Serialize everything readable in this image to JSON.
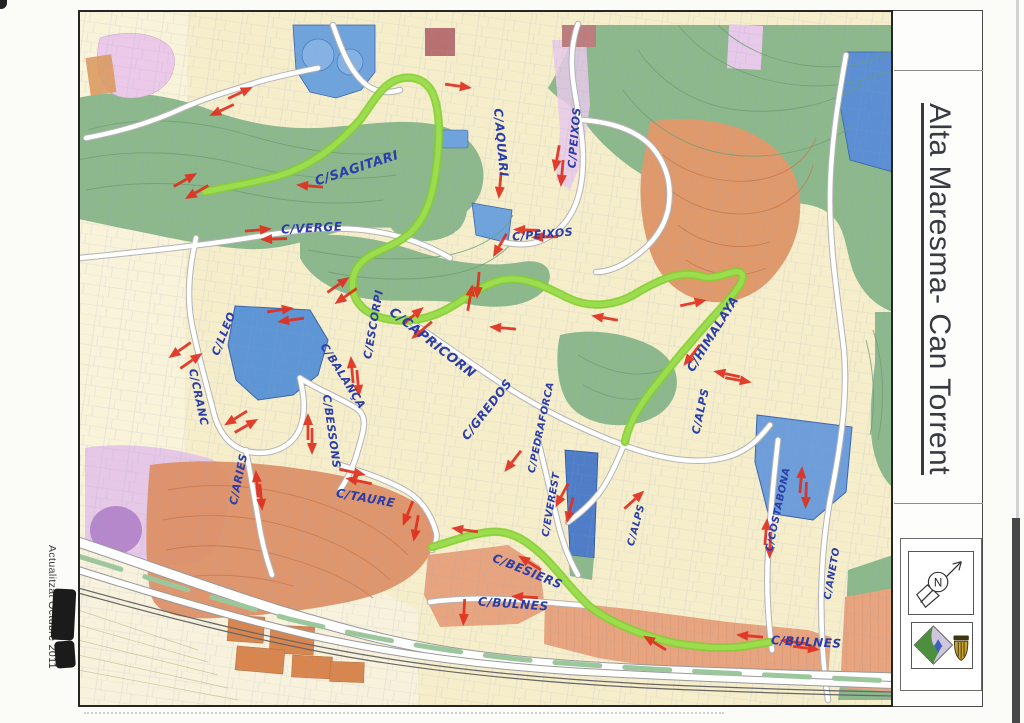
{
  "sheet": {
    "title": "Alta Maresma- Can Torrent",
    "margin_note": "Actualitzat",
    "margin_note_redacted": "Octubre 2011"
  },
  "legend": {
    "compass_letter": "N"
  },
  "map": {
    "colors": {
      "route": "#7fd41e",
      "arrow": "#e0301f",
      "handwriting": "#2b3da8"
    },
    "street_labels": [
      {
        "t": "C/SAGITARI",
        "x": 280,
        "y": 162,
        "r": -18,
        "s": 13
      },
      {
        "t": "C/VERGE",
        "x": 234,
        "y": 222,
        "r": -3,
        "s": 12
      },
      {
        "t": "C/AQUARI",
        "x": 419,
        "y": 133,
        "r": 85,
        "s": 12
      },
      {
        "t": "C/PEIXOS",
        "x": 465,
        "y": 228,
        "r": -5,
        "s": 11
      },
      {
        "t": "C/PEIXOS",
        "x": 500,
        "y": 128,
        "r": -85,
        "s": 11
      },
      {
        "t": "C/ESCORPI",
        "x": 299,
        "y": 315,
        "r": -80,
        "s": 11
      },
      {
        "t": "C/CAPRICORN",
        "x": 352,
        "y": 336,
        "r": 38,
        "s": 13
      },
      {
        "t": "C/LLEO",
        "x": 149,
        "y": 325,
        "r": -68,
        "s": 11
      },
      {
        "t": "C/CRANC",
        "x": 117,
        "y": 388,
        "r": 78,
        "s": 11
      },
      {
        "t": "C/BALANÇA",
        "x": 262,
        "y": 368,
        "r": 58,
        "s": 11
      },
      {
        "t": "C/BESSONS",
        "x": 250,
        "y": 422,
        "r": 82,
        "s": 11
      },
      {
        "t": "C/ARIES",
        "x": 164,
        "y": 470,
        "r": -78,
        "s": 11
      },
      {
        "t": "C/TAURE",
        "x": 287,
        "y": 492,
        "r": 10,
        "s": 12
      },
      {
        "t": "C/GREDOS",
        "x": 412,
        "y": 402,
        "r": -52,
        "s": 12
      },
      {
        "t": "C/PEDRAFORCA",
        "x": 466,
        "y": 418,
        "r": -78,
        "s": 10
      },
      {
        "t": "C/EVEREST",
        "x": 476,
        "y": 495,
        "r": -80,
        "s": 10
      },
      {
        "t": "C/ALPS",
        "x": 626,
        "y": 402,
        "r": -78,
        "s": 11
      },
      {
        "t": "C/HIMALAYA",
        "x": 638,
        "y": 326,
        "r": -58,
        "s": 12
      },
      {
        "t": "C/ALPS",
        "x": 561,
        "y": 516,
        "r": -75,
        "s": 10
      },
      {
        "t": "C/COSTABONA",
        "x": 703,
        "y": 500,
        "r": -78,
        "s": 10
      },
      {
        "t": "C/ANETO",
        "x": 757,
        "y": 564,
        "r": -80,
        "s": 10
      },
      {
        "t": "C/BESIERS",
        "x": 448,
        "y": 565,
        "r": 22,
        "s": 12
      },
      {
        "t": "C/BULNES",
        "x": 435,
        "y": 598,
        "r": 4,
        "s": 12
      },
      {
        "t": "C/BULNES",
        "x": 728,
        "y": 636,
        "r": 3,
        "s": 12
      }
    ],
    "routes": [
      "M127,182 C155,175 185,172 212,162 C242,150 262,132 282,110 C294,94 303,76 318,70 C334,64 348,70 354,82 C362,98 362,125 359,152 C356,180 350,205 334,221 C317,238 294,240 282,254 C271,267 272,287 286,299 C302,312 332,314 356,305 C381,296 396,278 420,271 C443,264 466,276 490,288 C513,299 540,296 562,281 C582,270 602,260 622,266 C640,272 658,256 664,264 C668,272 652,288 636,306 C616,328 596,352 577,376 C560,397 550,415 547,432",
      "M354,537 C372,532 392,524 412,522 C432,520 448,530 464,545 C478,558 492,578 510,595 C528,610 552,620 577,628 C602,636 640,640 668,636 C678,634 686,633 692,632"
    ],
    "arrows": [
      [
        162,
        83,
        -25
      ],
      [
        144,
        100,
        155
      ],
      [
        107,
        170,
        -30
      ],
      [
        119,
        182,
        150
      ],
      [
        232,
        176,
        185
      ],
      [
        380,
        76,
        8
      ],
      [
        422,
        175,
        95
      ],
      [
        422,
        235,
        120
      ],
      [
        479,
        148,
        100
      ],
      [
        484,
        163,
        95
      ],
      [
        449,
        220,
        182
      ],
      [
        467,
        227,
        178
      ],
      [
        180,
        220,
        -5
      ],
      [
        196,
        229,
        178
      ],
      [
        260,
        275,
        -35
      ],
      [
        268,
        286,
        145
      ],
      [
        400,
        275,
        95
      ],
      [
        392,
        288,
        -80
      ],
      [
        425,
        318,
        185
      ],
      [
        527,
        308,
        190
      ],
      [
        615,
        293,
        -12
      ],
      [
        614,
        345,
        128
      ],
      [
        335,
        306,
        -40
      ],
      [
        344,
        320,
        140
      ],
      [
        274,
        360,
        -95
      ],
      [
        280,
        373,
        85
      ],
      [
        202,
        300,
        -8
      ],
      [
        213,
        310,
        172
      ],
      [
        102,
        340,
        145
      ],
      [
        113,
        351,
        -35
      ],
      [
        158,
        408,
        148
      ],
      [
        168,
        416,
        -30
      ],
      [
        230,
        417,
        -90
      ],
      [
        234,
        431,
        90
      ],
      [
        179,
        474,
        -95
      ],
      [
        183,
        487,
        85
      ],
      [
        274,
        462,
        12
      ],
      [
        281,
        471,
        192
      ],
      [
        330,
        503,
        112
      ],
      [
        338,
        518,
        100
      ],
      [
        387,
        520,
        188
      ],
      [
        452,
        553,
        212
      ],
      [
        484,
        485,
        118
      ],
      [
        492,
        500,
        104
      ],
      [
        447,
        587,
        183
      ],
      [
        386,
        602,
        93
      ],
      [
        577,
        633,
        212
      ],
      [
        672,
        626,
        185
      ],
      [
        716,
        632,
        187
      ],
      [
        728,
        638,
        7
      ],
      [
        723,
        470,
        -85
      ],
      [
        728,
        485,
        92
      ],
      [
        688,
        522,
        -85
      ],
      [
        692,
        535,
        92
      ],
      [
        649,
        364,
        192
      ],
      [
        660,
        370,
        10
      ],
      [
        556,
        490,
        -42
      ],
      [
        435,
        451,
        128
      ]
    ]
  }
}
